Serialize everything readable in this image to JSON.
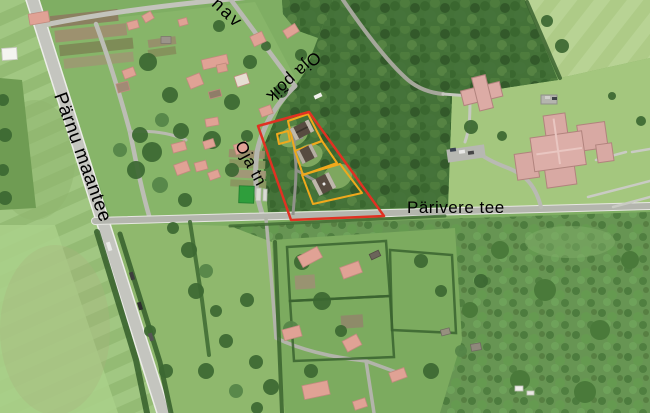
{
  "map": {
    "title": "Aerial orthophoto with highlighted cadastral parcels",
    "labels": {
      "street_top_partial": "nav",
      "oja_poik": "Oja põik",
      "oja_tn": "Oja tn",
      "parivere_tee": "Pärivere tee",
      "parnu_maantee": "Pärnu maantee"
    },
    "label_color": "#000000",
    "highlight": {
      "selection_color": "#e03122",
      "parcel_color": "#f0a91c"
    }
  }
}
